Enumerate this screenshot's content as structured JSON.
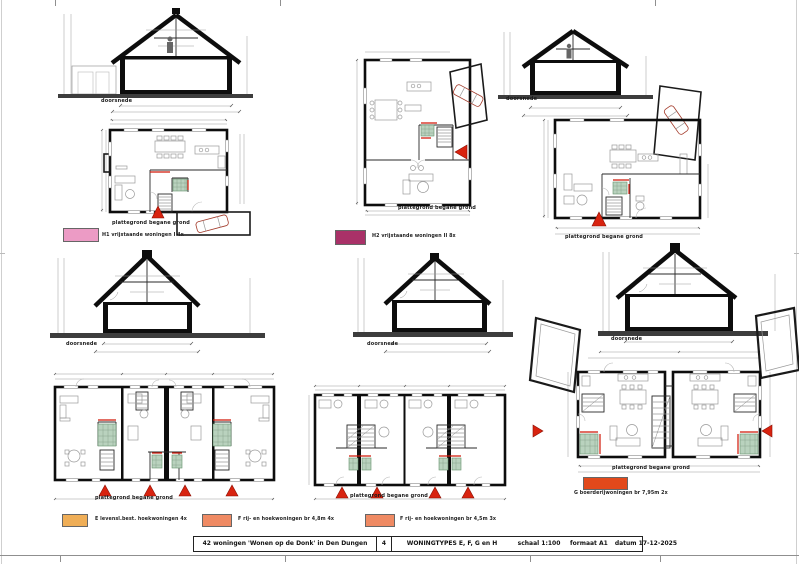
{
  "sheet": {
    "labels": {
      "section": "doorsnede",
      "plan": "plattegrond begane grond"
    },
    "legends": [
      {
        "code": "H1",
        "label": "H1 vrijstaande woningen I  4x",
        "color": "#ec9bc5"
      },
      {
        "code": "H2",
        "label": "H2 vrijstaande woningen II  8x",
        "color": "#a93168"
      },
      {
        "code": "E",
        "label": "E levensl.best. hoekwoningen  4x",
        "color": "#efae57"
      },
      {
        "code": "F1",
        "label": "F rij- en hoekwoningen br 4,8m  4x",
        "color": "#ef8a63"
      },
      {
        "code": "F2",
        "label": "F rij- en hoekwoningen br 4,5m  3x",
        "color": "#ef8a63"
      },
      {
        "code": "G",
        "label": "G boerderijwoningen br 7,95m  2x",
        "color": "#e2491b"
      }
    ],
    "title_block": {
      "project": "42 woningen 'Wonen op de Donk' in Den Dungen",
      "sheet_number": "4",
      "sheet_title": "WONINGTYPES E, F, G en H",
      "scale": "schaal 1:100",
      "format": "formaat A1",
      "date": "datum 17-12-2025"
    },
    "colors": {
      "marker_red": "#d8230f",
      "wall_black": "#0d0d0d",
      "tile_green": "#b9d2be"
    }
  }
}
